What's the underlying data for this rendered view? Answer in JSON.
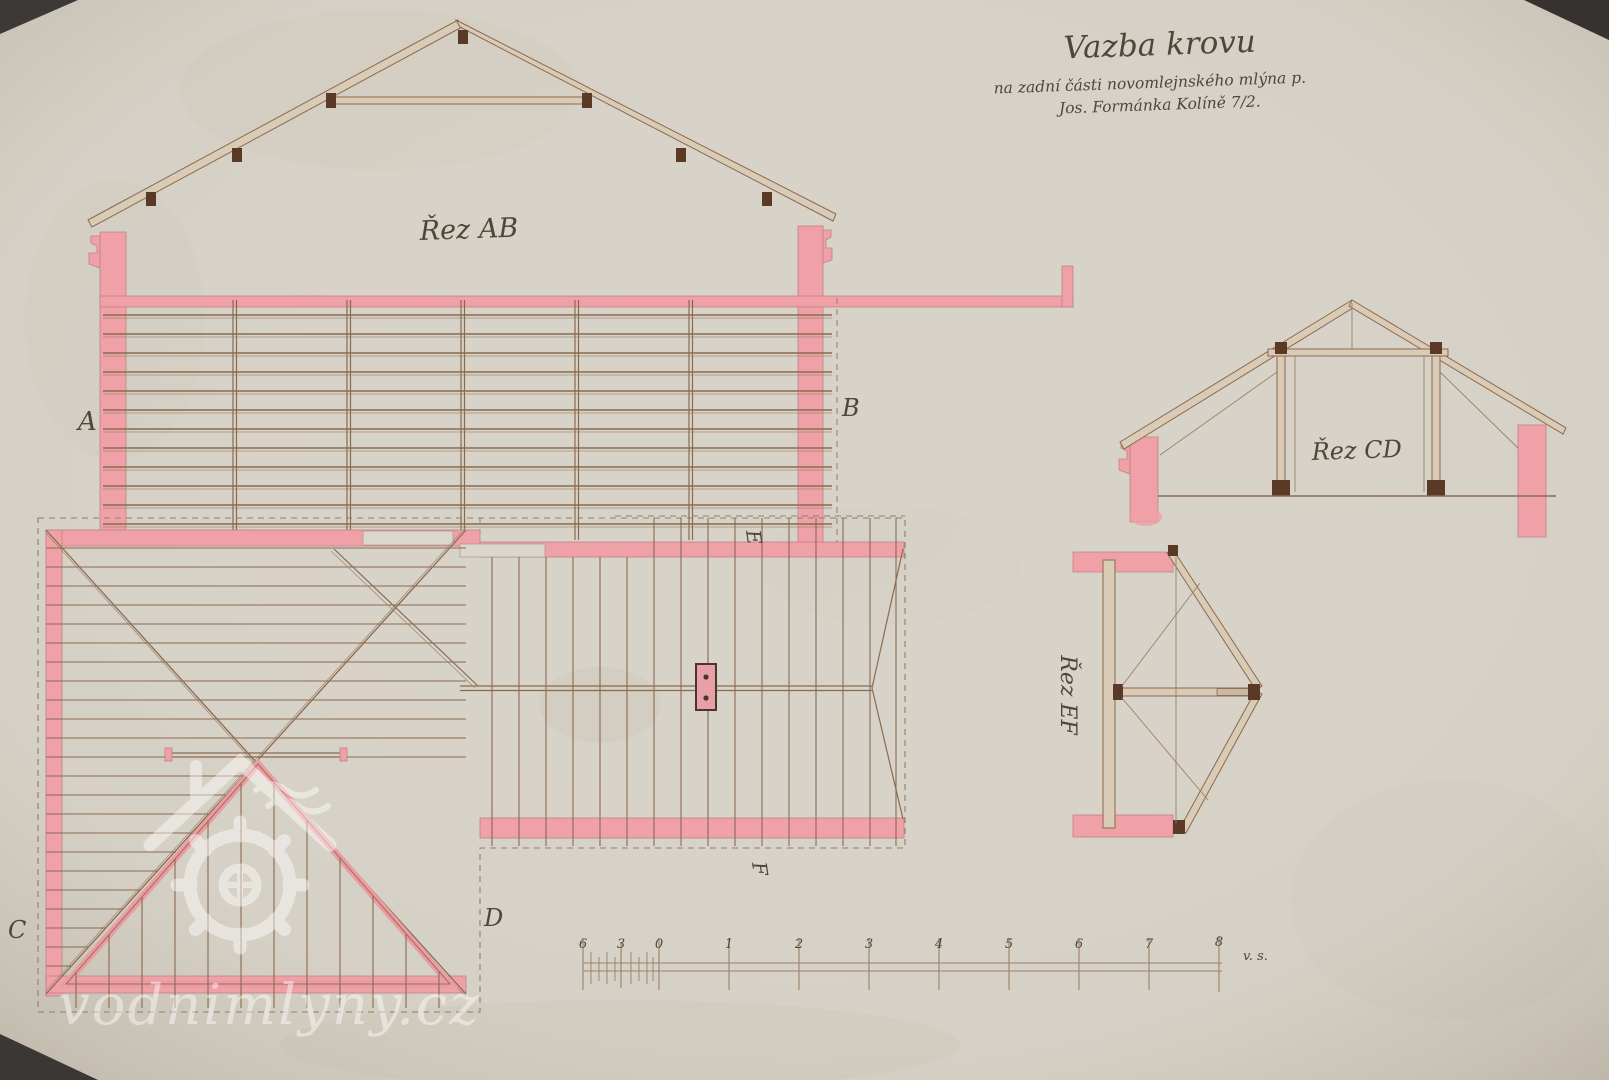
{
  "title": {
    "line1": "Vazba krovu",
    "line2": "na zadní části novomlejnského mlýna p.",
    "line3": "Jos. Formánka Kolíně 7/2."
  },
  "labels": {
    "section_ab": "Řez AB",
    "section_cd": "Řez CD",
    "section_ef": "Řez EF"
  },
  "markers": {
    "a": "A",
    "b": "B",
    "c": "C",
    "d": "D",
    "e": "E",
    "f": "F"
  },
  "scale": {
    "tick_labels": [
      "6",
      "3",
      "0",
      "1",
      "2",
      "3",
      "4",
      "5",
      "6",
      "7",
      "8"
    ],
    "unit": "v. s."
  },
  "watermark": {
    "site": "vodnimlyny.cz"
  },
  "colors": {
    "paper": "#d8d3c9",
    "pink_wash": "#efa1a7",
    "ink_brown": "#8a6a4f",
    "ink_dark": "#4f4639",
    "watermark_white": "#ffffff"
  }
}
